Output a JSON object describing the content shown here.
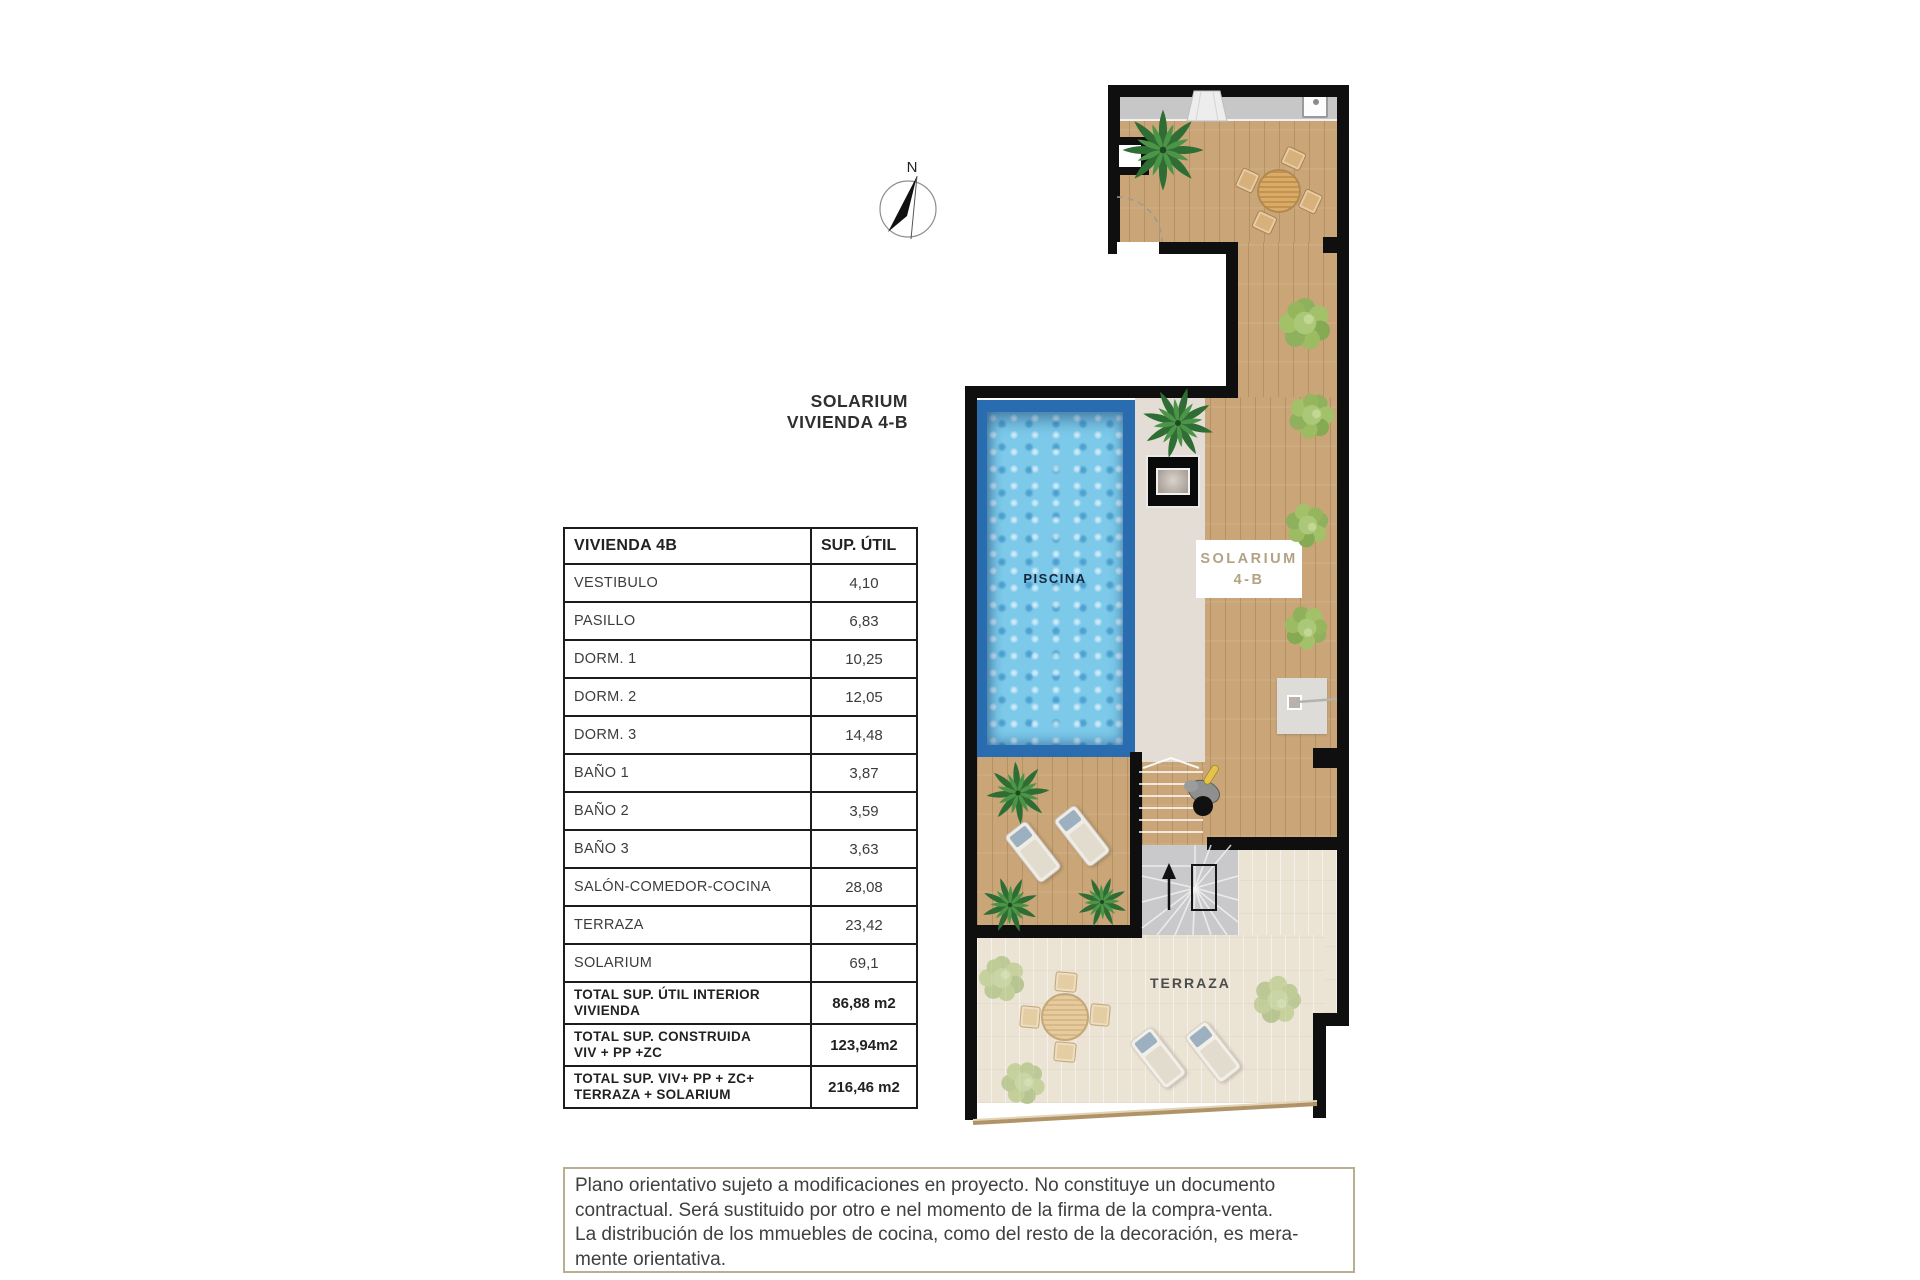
{
  "title": {
    "text": "SOLARIUM\nVIVIENDA 4-B"
  },
  "compass": {
    "north_label": "N"
  },
  "table": {
    "header": {
      "name": "VIVIENDA 4B",
      "area": "SUP. ÚTIL"
    },
    "rows": [
      {
        "label": "VESTIBULO",
        "value": "4,10"
      },
      {
        "label": "PASILLO",
        "value": "6,83"
      },
      {
        "label": "DORM. 1",
        "value": "10,25"
      },
      {
        "label": "DORM. 2",
        "value": "12,05"
      },
      {
        "label": "DORM. 3",
        "value": "14,48"
      },
      {
        "label": "BAÑO 1",
        "value": "3,87"
      },
      {
        "label": "BAÑO 2",
        "value": "3,59"
      },
      {
        "label": "BAÑO 3",
        "value": "3,63"
      },
      {
        "label": "SALÓN-COMEDOR-COCINA",
        "value": "28,08"
      },
      {
        "label": "TERRAZA",
        "value": "23,42"
      },
      {
        "label": "SOLARIUM",
        "value": "69,1"
      }
    ],
    "totals": [
      {
        "label": "TOTAL SUP. ÚTIL INTERIOR\nVIVIENDA",
        "value": "86,88 m2"
      },
      {
        "label": "TOTAL SUP. CONSTRUIDA\nVIV + PP +ZC",
        "value": "123,94m2"
      },
      {
        "label": "TOTAL SUP. VIV+ PP + ZC+\nTERRAZA + SOLARIUM",
        "value": "216,46 m2"
      }
    ]
  },
  "plan": {
    "piscina_label": "PISCINA",
    "solarium_box": {
      "line1": "SOLARIUM",
      "line2": "4-B"
    },
    "terraza_label": "TERRAZA",
    "colors": {
      "wall": "#0f0f0f",
      "wood": "#c9a577",
      "terrace": "#ebe3d4",
      "concrete": "#e3ddd5",
      "pool-border": "#2a6cb0",
      "pool-water": "#7cc9ea",
      "tan": "#b3a284",
      "note-border": "#b9ae8f"
    }
  },
  "disclaimer": {
    "text": "Plano orientativo sujeto a modificaciones en proyecto. No constituye un documento\ncontractual. Será sustituido por otro e nel momento de la firma de la compra-venta.\nLa distribución de los mmuebles de cocina, como del resto de la decoración, es mera-\nmente orientativa."
  }
}
